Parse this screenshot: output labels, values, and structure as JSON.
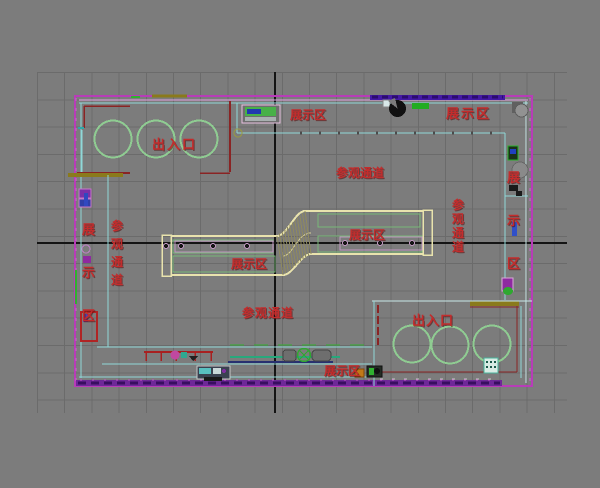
{
  "viewport": {
    "background_color": "#7C7C7C",
    "grid_line_color": "#6B6B6B",
    "axis_color": "#141414"
  },
  "plan": {
    "colors": {
      "wall_magenta": "#B83CB8",
      "wall_purple_bar": "#5A1FA0",
      "corridor_cyan": "#8FD8D8",
      "detail_dark_red": "#8A2424",
      "display_counter_yellow": "#E9E3AD",
      "inner_green": "#79B879",
      "circle_green": "#8FCC92",
      "olive_bar": "#8A7A1C",
      "label_red": "#C42C2C"
    },
    "labels": [
      {
        "id": "entrance-exit-top",
        "text": "出入口",
        "orientation": "horizontal"
      },
      {
        "id": "display-area-top-left",
        "text": "展示区",
        "orientation": "horizontal"
      },
      {
        "id": "display-area-top-right",
        "text": "展示区",
        "orientation": "horizontal"
      },
      {
        "id": "visitor-passage-top",
        "text": "参观通道",
        "orientation": "horizontal"
      },
      {
        "id": "display-area-right",
        "text": "展示区",
        "orientation": "vertical"
      },
      {
        "id": "visitor-passage-right",
        "text": "参观通道",
        "orientation": "vertical"
      },
      {
        "id": "display-area-center-left",
        "text": "展示区",
        "orientation": "horizontal"
      },
      {
        "id": "display-area-center-right",
        "text": "展示区",
        "orientation": "horizontal"
      },
      {
        "id": "display-area-left",
        "text": "展示区",
        "orientation": "vertical"
      },
      {
        "id": "visitor-passage-left",
        "text": "参观通道",
        "orientation": "vertical"
      },
      {
        "id": "visitor-passage-bottom",
        "text": "参观通道",
        "orientation": "horizontal"
      },
      {
        "id": "display-area-bottom",
        "text": "展示区",
        "orientation": "horizontal"
      },
      {
        "id": "entrance-exit-bottom",
        "text": "出入口",
        "orientation": "horizontal"
      }
    ]
  }
}
